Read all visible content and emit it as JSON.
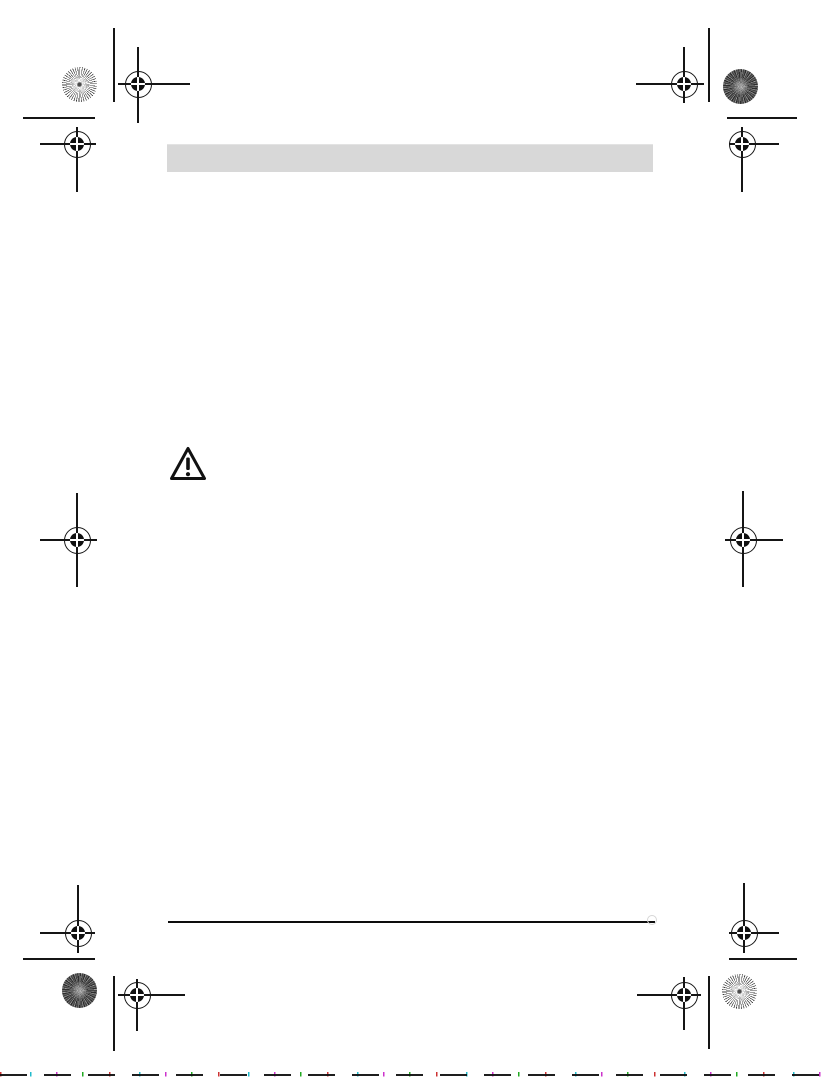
{
  "page": {
    "background_color": "#ffffff",
    "ink_color": "#151515",
    "header_bar": {
      "text": "",
      "fill_color": "#d8d8d8"
    },
    "body_text": "",
    "warning_icon": {
      "name": "warning-triangle-icon",
      "glyph": "!",
      "stroke_color": "#111111"
    },
    "footer_rule": {
      "color": "#0d0d0d"
    },
    "print_marks": {
      "registration_mark_count": 8,
      "crop_line_count": 4,
      "short_rule_count": 4,
      "color_patches": [
        {
          "position": "top-left",
          "style": "sunburst-light"
        },
        {
          "position": "top-right",
          "style": "halftone-dark"
        },
        {
          "position": "bottom-left",
          "style": "halftone-dark"
        },
        {
          "position": "bottom-right",
          "style": "sunburst-light"
        }
      ]
    },
    "scan_noise_colors": [
      "#121212",
      "#cc3333",
      "#22bbcc",
      "#cc33cc",
      "#22aa22"
    ]
  }
}
